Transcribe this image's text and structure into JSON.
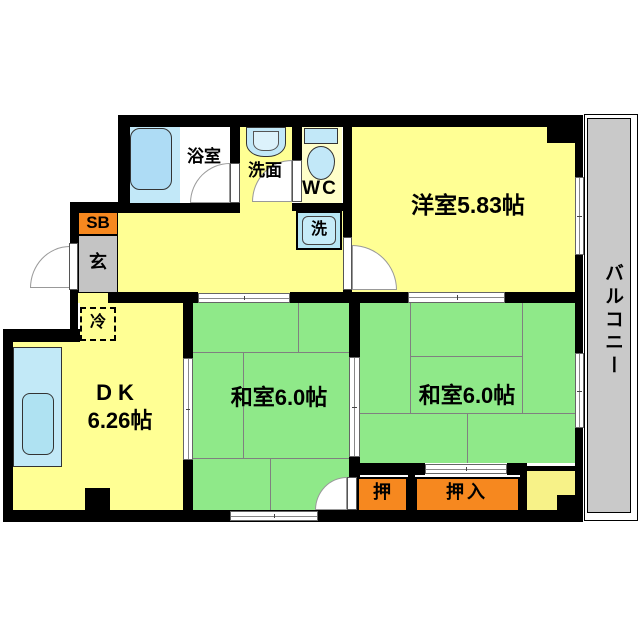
{
  "plan_title": "2DK apartment floor plan",
  "rooms": {
    "bath": {
      "label": "浴室"
    },
    "washroom": {
      "label": "洗面"
    },
    "wc": {
      "label": "WC"
    },
    "laundry": {
      "label": "洗"
    },
    "western": {
      "label": "洋室5.83帖"
    },
    "balcony": {
      "label": "バルコニー"
    },
    "shoebox": {
      "label": "SB"
    },
    "entrance": {
      "label": "玄"
    },
    "fridge": {
      "label": "冷"
    },
    "dk": {
      "label": "DK",
      "size": "6.26帖"
    },
    "tatami_left": {
      "label": "和室6.0帖"
    },
    "tatami_right": {
      "label": "和室6.0帖"
    },
    "closet_small": {
      "label": "押"
    },
    "closet_large": {
      "label": "押入"
    }
  },
  "colors": {
    "wall": "#000000",
    "room_yellow": "#FFFF94",
    "wc_pale_yellow": "#FFFFC9",
    "corner_pale_yellow": "#F7F288",
    "tatami_green": "#8FE989",
    "closet_orange": "#F6881F",
    "entrance_gray": "#C4C4C4",
    "balcony_gray": "#C9C9C9",
    "fixture_blue": "#C2E8F8",
    "tub_blue": "#AEDCF5",
    "sink_blue": "#AFE2F2",
    "tatami_line_gray": "#808080"
  }
}
